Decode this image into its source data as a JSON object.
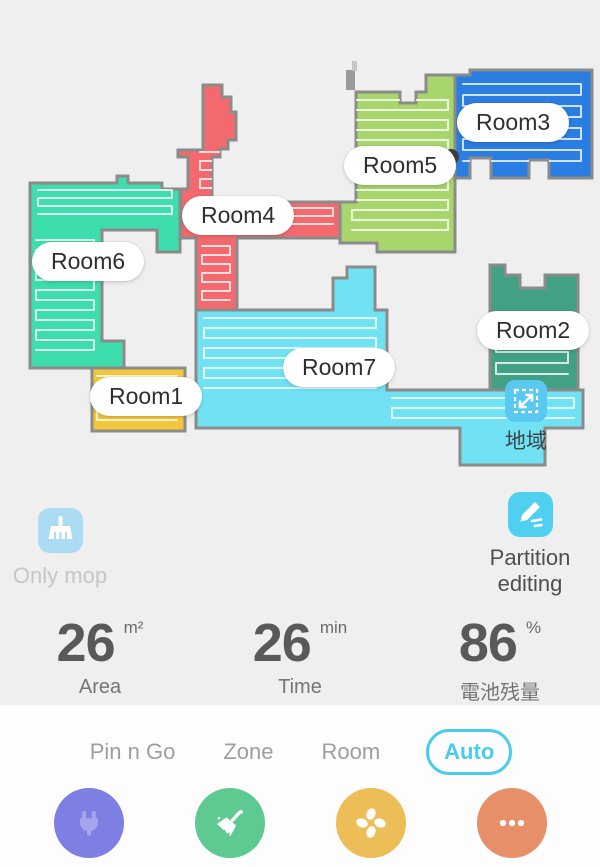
{
  "theme": {
    "background": "#efeff0",
    "panel": "#fdfdfd",
    "accent_cyan": "#49cce9",
    "wall": "#8b8b8b",
    "icon_blue_light": "#abdcf3",
    "icon_cyan": "#4fd0f0",
    "region_icon_blue": "#59c9f2"
  },
  "map": {
    "region_label": "地域",
    "robot": {
      "x": 451,
      "y": 157,
      "r": 8
    },
    "rooms": [
      {
        "name": "Room4",
        "color": "#f4696e",
        "label_x": 182,
        "label_y": 196,
        "d": "M 203 85 L 222 85 L 222 97 L 231 97 L 231 112 L 236 112 L 236 140 L 228 140 L 228 149 L 220 149 L 220 157 L 212 157 L 212 202 L 340 202 L 340 238 L 237 238 L 237 310 L 196 310 L 196 238 L 181 238 L 181 189 L 188 189 L 188 157 L 178 157 L 178 150 L 203 150 Z"
      },
      {
        "name": "Room5",
        "color": "#a8d56c",
        "label_x": 344,
        "label_y": 146,
        "d": "M 356 92 L 400 92 L 400 103 L 416 103 L 416 92 L 426 92 L 426 75 L 455 75 L 455 252 L 377 252 L 377 243 L 340 243 L 340 202 L 356 202 Z"
      },
      {
        "name": "Room3",
        "color": "#2a7de1",
        "label_x": 457,
        "label_y": 103,
        "d": "M 455 75 L 470 75 L 470 70 L 592 70 L 592 178 L 549 178 L 549 160 L 529 160 L 529 178 L 491 178 L 491 158 L 470 158 L 470 178 L 455 178 Z"
      },
      {
        "name": "Room6",
        "color": "#3eddad",
        "label_x": 32,
        "label_y": 242,
        "d": "M 30 183 L 117 183 L 117 176 L 128 176 L 128 183 L 162 183 L 162 189 L 180 189 L 180 252 L 157 252 L 157 230 L 102 230 L 102 341 L 124 341 L 124 368 L 30 368 Z"
      },
      {
        "name": "Room7",
        "color": "#70e2f4",
        "label_x": 283,
        "label_y": 348,
        "d": "M 196 310 L 333 310 L 333 278 L 347 278 L 347 267 L 375 267 L 375 310 L 387 310 L 387 390 L 583 390 L 583 428 L 545 428 L 545 465 L 460 465 L 460 428 L 196 428 Z"
      },
      {
        "name": "Room2",
        "color": "#42a184",
        "label_x": 477,
        "label_y": 311,
        "d": "M 490 265 L 505 265 L 505 275 L 520 275 L 520 288 L 545 288 L 545 275 L 578 275 L 578 390 L 490 390 Z"
      },
      {
        "name": "Room1",
        "color": "#f3c73b",
        "label_x": 90,
        "label_y": 377,
        "d": "M 92 368 L 185 368 L 185 431 L 92 431 Z"
      }
    ],
    "traces": [
      {
        "room": 3,
        "x": 38,
        "y": 190,
        "w": 134,
        "h": 30,
        "gap": 8
      },
      {
        "room": 3,
        "x": 36,
        "y": 240,
        "w": 58,
        "h": 118,
        "gap": 10
      },
      {
        "room": 0,
        "x": 218,
        "y": 208,
        "w": 115,
        "h": 22,
        "gap": 8
      },
      {
        "room": 0,
        "x": 202,
        "y": 246,
        "w": 28,
        "h": 58,
        "gap": 9
      },
      {
        "room": 0,
        "x": 200,
        "y": 152,
        "w": 30,
        "h": 46,
        "gap": 9
      },
      {
        "room": 1,
        "x": 352,
        "y": 100,
        "w": 96,
        "h": 138,
        "gap": 10
      },
      {
        "room": 2,
        "x": 463,
        "y": 84,
        "w": 118,
        "h": 84,
        "gap": 11
      },
      {
        "room": 4,
        "x": 204,
        "y": 318,
        "w": 172,
        "h": 76,
        "gap": 10
      },
      {
        "room": 4,
        "x": 392,
        "y": 398,
        "w": 182,
        "h": 22,
        "gap": 10
      },
      {
        "room": 6,
        "x": 97,
        "y": 376,
        "w": 80,
        "h": 48,
        "gap": 11
      },
      {
        "room": 5,
        "x": 496,
        "y": 330,
        "w": 72,
        "h": 52,
        "gap": 11
      }
    ]
  },
  "features": {
    "only_mop": {
      "label": "Only mop"
    },
    "partition_editing": {
      "label": "Partition editing"
    }
  },
  "stats": [
    {
      "value": "26",
      "unit": "m²",
      "label": "Area"
    },
    {
      "value": "26",
      "unit": "min",
      "label": "Time"
    },
    {
      "value": "86",
      "unit": "%",
      "label": "電池残量"
    }
  ],
  "tabs": [
    {
      "label": "Pin n Go",
      "active": false
    },
    {
      "label": "Zone",
      "active": false
    },
    {
      "label": "Room",
      "active": false
    },
    {
      "label": "Auto",
      "active": true
    }
  ],
  "actions": [
    {
      "name": "dock-button",
      "icon": "plug-icon",
      "color": "#7d80e2"
    },
    {
      "name": "clean-button",
      "icon": "broom-icon",
      "color": "#5eca91"
    },
    {
      "name": "fan-speed-button",
      "icon": "fan-icon",
      "color": "#edbd57"
    },
    {
      "name": "more-button",
      "icon": "ellipsis-icon",
      "color": "#e78f68"
    }
  ]
}
